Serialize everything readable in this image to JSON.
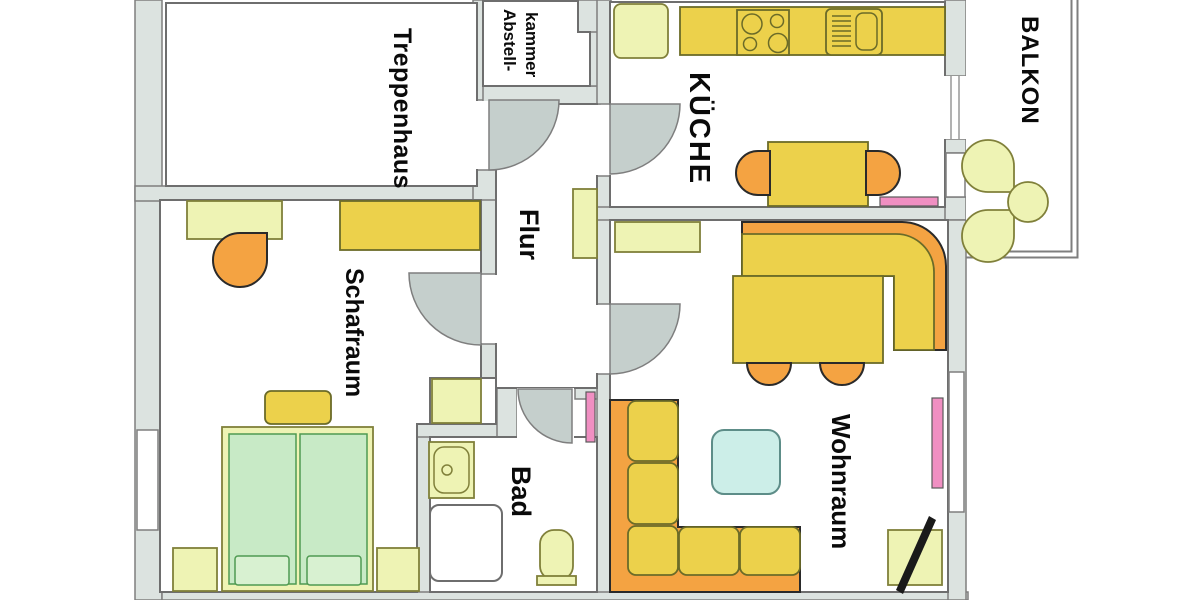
{
  "rooms": {
    "treppenhaus": {
      "label": "Treppenhaus"
    },
    "abstellkammer": {
      "line1": "Abstell-",
      "line2": "kammer"
    },
    "kueche": {
      "label": "KÜCHE"
    },
    "flur": {
      "label": "Flur"
    },
    "schafraum": {
      "label": "Schafraum"
    },
    "bad": {
      "label": "Bad"
    },
    "wohnraum": {
      "label": "Wohnraum"
    },
    "balkon": {
      "label": "BALKON"
    }
  },
  "colors": {
    "wall": "#dce3e0",
    "wallStroke": "#7e7e7e",
    "roomFill": "#ffffff",
    "roomStroke": "#6e6e6e",
    "yellow": "#ecd14b",
    "pale": "#eef3b4",
    "orange": "#f4a342",
    "green": "#c8eac6",
    "greenLight": "#d8f1d1",
    "cyan": "#cceee8",
    "pink": "#f08fc2",
    "door": "#c5cfcc"
  }
}
